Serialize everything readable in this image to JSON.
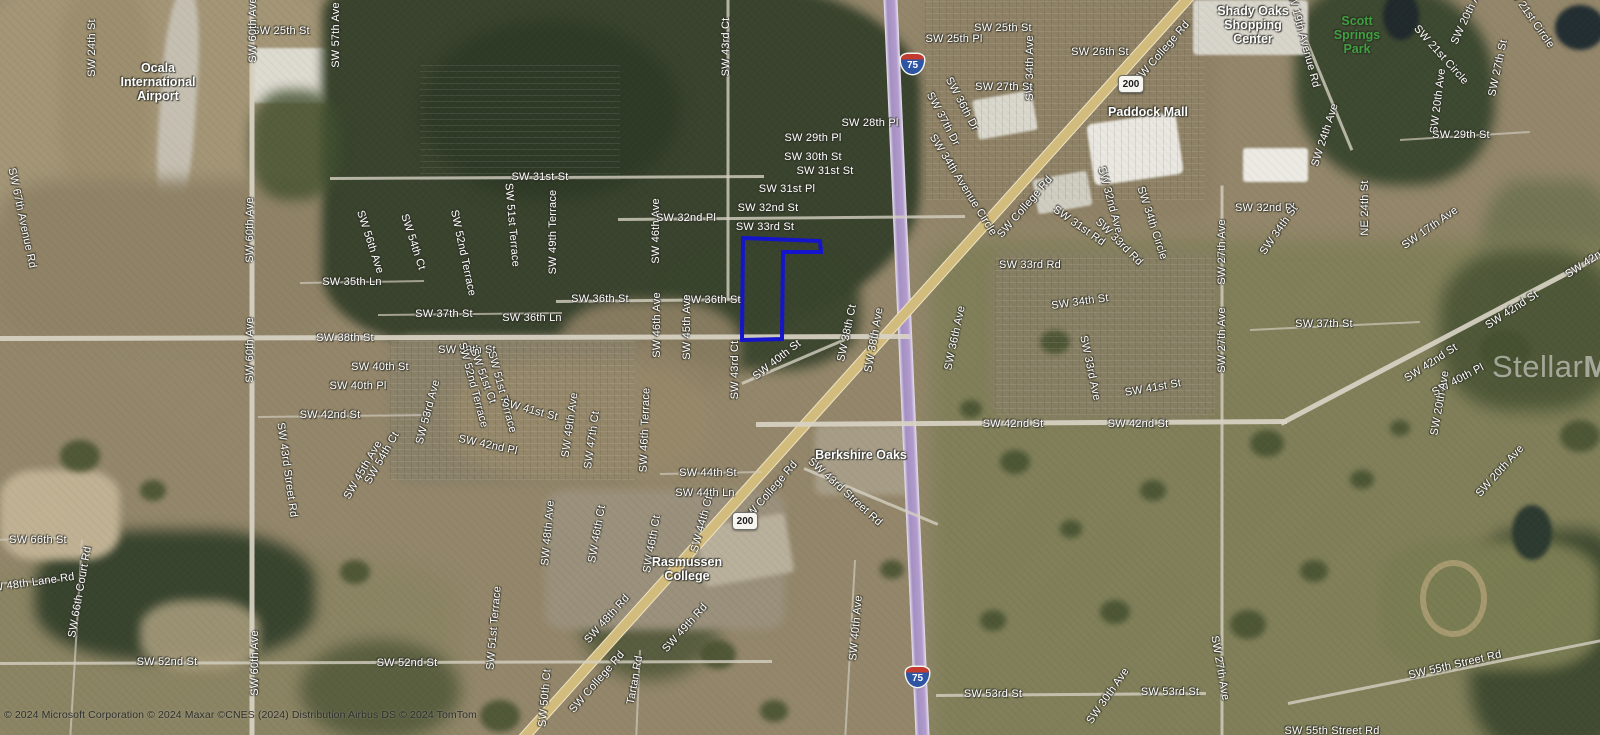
{
  "map": {
    "width": 1600,
    "height": 735,
    "attribution": "© 2024 Microsoft Corporation © 2024 Maxar ©CNES (2024) Distribution Airbus DS © 2024 TomTom",
    "watermark": {
      "brand_regular": "Stellar",
      "brand_bold": "MLS"
    },
    "colors": {
      "parcel_stroke": "#1414cd",
      "interstate_fill": "#2e55a3",
      "interstate_band": "#c23b2e",
      "state_shield_fill": "#f6f5f0",
      "park_label_green": "#3fa03f",
      "label_white": "#ffffff"
    },
    "parcel": {
      "stroke": "#1414cd",
      "stroke_width": 4,
      "points": [
        [
          743,
          238
        ],
        [
          820,
          241
        ],
        [
          821,
          252
        ],
        [
          783,
          252
        ],
        [
          782,
          339
        ],
        [
          742,
          340
        ]
      ]
    },
    "shields": [
      {
        "kind": "interstate",
        "t": "75",
        "x": 913,
        "y": 64
      },
      {
        "kind": "interstate",
        "t": "75",
        "x": 918,
        "y": 677
      },
      {
        "kind": "state",
        "t": "200",
        "x": 1130,
        "y": 85
      },
      {
        "kind": "state",
        "t": "200",
        "x": 744,
        "y": 522
      }
    ],
    "poi_labels": [
      {
        "t": "Ocala\nInternational\nAirport",
        "x": 158,
        "y": 82
      },
      {
        "t": "Shady Oaks\nShopping\nCenter",
        "x": 1253,
        "y": 25
      },
      {
        "t": "Scott\nSprings\nPark",
        "x": 1357,
        "y": 35,
        "c": "#3fa03f"
      },
      {
        "t": "Paddock Mall",
        "x": 1148,
        "y": 112
      },
      {
        "t": "Berkshire Oaks",
        "x": 861,
        "y": 455
      },
      {
        "t": "Rasmussen\nCollege",
        "x": 687,
        "y": 569
      }
    ],
    "roads": [
      {
        "n": "I-75",
        "k": "i",
        "x1": 890,
        "y1": -12,
        "x2": 923,
        "y2": 747
      },
      {
        "n": "SW College Rd",
        "k": "hw",
        "x1": 1196,
        "y1": -12,
        "x2": 514,
        "y2": 747
      },
      {
        "n": "SW 38th St",
        "k": "maj",
        "x1": -8,
        "y1": 338,
        "x2": 910,
        "y2": 336
      },
      {
        "n": "SW 42nd St",
        "k": "maj",
        "x1": 756,
        "y1": 424,
        "x2": 1287,
        "y2": 421
      },
      {
        "n": "SW 42nd St E",
        "k": "maj",
        "x1": 1281,
        "y1": 423,
        "x2": 1612,
        "y2": 249
      },
      {
        "n": "SW 60th Ave",
        "k": "maj",
        "x1": 252,
        "y1": -8,
        "x2": 252,
        "y2": 742
      },
      {
        "n": "SW 27th Ave",
        "k": "min",
        "x1": 1222,
        "y1": 185,
        "x2": 1222,
        "y2": 742
      },
      {
        "n": "SW 43rd Ct",
        "k": "min",
        "x1": 728,
        "y1": -8,
        "x2": 728,
        "y2": 300
      },
      {
        "n": "SW 31st St",
        "k": "min",
        "x1": 330,
        "y1": 178,
        "x2": 764,
        "y2": 176
      },
      {
        "n": "SW 32nd Pl",
        "k": "min",
        "x1": 618,
        "y1": 219,
        "x2": 965,
        "y2": 216
      },
      {
        "n": "SW 36th St",
        "k": "min",
        "x1": 556,
        "y1": 301,
        "x2": 744,
        "y2": 299
      },
      {
        "n": "SW 52nd St",
        "k": "min",
        "x1": -8,
        "y1": 663,
        "x2": 772,
        "y2": 661
      },
      {
        "n": "SW 53rd St",
        "k": "min",
        "x1": 936,
        "y1": 695,
        "x2": 1206,
        "y2": 693
      },
      {
        "n": "SW 55th Street Rd",
        "k": "min",
        "x1": 1288,
        "y1": 703,
        "x2": 1612,
        "y2": 638
      },
      {
        "n": "SW 43rd Street Rd",
        "k": "min",
        "x1": 804,
        "y1": 468,
        "x2": 938,
        "y2": 524
      },
      {
        "n": "SW 35th Ln",
        "k": "thin",
        "x1": 300,
        "y1": 283,
        "x2": 424,
        "y2": 281
      },
      {
        "n": "SW 37th St",
        "k": "thin",
        "x1": 378,
        "y1": 315,
        "x2": 562,
        "y2": 313
      },
      {
        "n": "SW 40th St",
        "k": "min",
        "x1": 742,
        "y1": 383,
        "x2": 845,
        "y2": 339
      },
      {
        "n": "SW 44th St",
        "k": "thin",
        "x1": 660,
        "y1": 474,
        "x2": 762,
        "y2": 472
      },
      {
        "n": "SW 19th Avenue Rd",
        "k": "min",
        "x1": 1290,
        "y1": 0,
        "x2": 1352,
        "y2": 150
      },
      {
        "n": "SW 66th Court Rd",
        "k": "thin",
        "x1": 82,
        "y1": 540,
        "x2": 70,
        "y2": 742
      },
      {
        "n": "SW 48th Lane Rd",
        "k": "thin",
        "x1": -8,
        "y1": 584,
        "x2": 60,
        "y2": 580
      },
      {
        "n": "SW 66th St",
        "k": "thin",
        "x1": -8,
        "y1": 540,
        "x2": 60,
        "y2": 538
      },
      {
        "n": "SW 42nd St W",
        "k": "thin",
        "x1": 258,
        "y1": 417,
        "x2": 430,
        "y2": 415
      },
      {
        "n": "SW 37th St E",
        "k": "thin",
        "x1": 1250,
        "y1": 330,
        "x2": 1420,
        "y2": 322
      },
      {
        "n": "SW 40th Ave",
        "k": "thin",
        "x1": 855,
        "y1": 560,
        "x2": 845,
        "y2": 742
      },
      {
        "n": "SW 29th St E",
        "k": "thin",
        "x1": 1400,
        "y1": 140,
        "x2": 1530,
        "y2": 132
      },
      {
        "n": "Tartan Rd",
        "k": "thin",
        "x1": 640,
        "y1": 650,
        "x2": 636,
        "y2": 742
      }
    ],
    "road_labels": [
      {
        "t": "SW 24th St",
        "x": 92,
        "y": 48,
        "r": -90
      },
      {
        "t": "SW 25th St",
        "x": 281,
        "y": 31,
        "r": 0
      },
      {
        "t": "SW 60th Ave",
        "x": 253,
        "y": 30,
        "r": -90
      },
      {
        "t": "SW 57th Ave",
        "x": 336,
        "y": 35,
        "r": -90
      },
      {
        "t": "SW 67th Avenue Rd",
        "x": 22,
        "y": 218,
        "r": 78
      },
      {
        "t": "SW 60th Ave",
        "x": 250,
        "y": 230,
        "r": -90
      },
      {
        "t": "SW 56th Ave",
        "x": 370,
        "y": 242,
        "r": 72
      },
      {
        "t": "SW 54th Ct",
        "x": 413,
        "y": 242,
        "r": 72
      },
      {
        "t": "SW 52nd Terrace",
        "x": 463,
        "y": 253,
        "r": 78
      },
      {
        "t": "SW 51st Terrace",
        "x": 512,
        "y": 225,
        "r": 85
      },
      {
        "t": "SW 49th Terrace",
        "x": 553,
        "y": 232,
        "r": -90
      },
      {
        "t": "SW 31st St",
        "x": 540,
        "y": 177,
        "r": 0
      },
      {
        "t": "SW 43rd Ct",
        "x": 726,
        "y": 47,
        "r": -90
      },
      {
        "t": "SW 46th Ave",
        "x": 656,
        "y": 231,
        "r": -90
      },
      {
        "t": "SW 32nd Pl",
        "x": 686,
        "y": 218,
        "r": 0
      },
      {
        "t": "SW 32nd St",
        "x": 768,
        "y": 208,
        "r": 0
      },
      {
        "t": "SW 31st Pl",
        "x": 787,
        "y": 189,
        "r": 0
      },
      {
        "t": "SW 31st St",
        "x": 825,
        "y": 171,
        "r": 0
      },
      {
        "t": "SW 30th St",
        "x": 813,
        "y": 157,
        "r": 0
      },
      {
        "t": "SW 29th Pl",
        "x": 813,
        "y": 138,
        "r": 0
      },
      {
        "t": "SW 28th Pl",
        "x": 870,
        "y": 123,
        "r": 0
      },
      {
        "t": "SW 33rd St",
        "x": 765,
        "y": 227,
        "r": 0
      },
      {
        "t": "SW 25th Pl",
        "x": 954,
        "y": 39,
        "r": 0
      },
      {
        "t": "SW 25th St",
        "x": 1003,
        "y": 28,
        "r": 0
      },
      {
        "t": "SW 26th St",
        "x": 1100,
        "y": 52,
        "r": 0
      },
      {
        "t": "SW 34th Ave",
        "x": 1030,
        "y": 68,
        "r": -90
      },
      {
        "t": "SW 27th St",
        "x": 1004,
        "y": 87,
        "r": 0
      },
      {
        "t": "SW 36th Dr",
        "x": 962,
        "y": 104,
        "r": 62
      },
      {
        "t": "SW 37th Dr",
        "x": 943,
        "y": 119,
        "r": 62
      },
      {
        "t": "SW College Rd",
        "x": 1162,
        "y": 52,
        "r": -49
      },
      {
        "t": "SW 34th Avenue Circle",
        "x": 963,
        "y": 185,
        "r": 58
      },
      {
        "t": "SW College Rd",
        "x": 1025,
        "y": 207,
        "r": -49
      },
      {
        "t": "SW 32nd Ave",
        "x": 1110,
        "y": 200,
        "r": 75
      },
      {
        "t": "SW 31st Rd",
        "x": 1079,
        "y": 226,
        "r": 35
      },
      {
        "t": "SW 34th Circle",
        "x": 1152,
        "y": 223,
        "r": 72
      },
      {
        "t": "SW 33rd Rd",
        "x": 1119,
        "y": 242,
        "r": 45
      },
      {
        "t": "SW 19th Avenue Rd",
        "x": 1303,
        "y": 38,
        "r": 75
      },
      {
        "t": "SW 20th Ave",
        "x": 1468,
        "y": 14,
        "r": -65
      },
      {
        "t": "SW 21st Circle",
        "x": 1530,
        "y": 16,
        "r": 55
      },
      {
        "t": "SW 21st Circle",
        "x": 1441,
        "y": 55,
        "r": 48
      },
      {
        "t": "SW 27th St",
        "x": 1498,
        "y": 68,
        "r": -78
      },
      {
        "t": "SW 20th Ave",
        "x": 1438,
        "y": 101,
        "r": -83
      },
      {
        "t": "SW 29th St",
        "x": 1461,
        "y": 135,
        "r": 0
      },
      {
        "t": "SW 24th Ave",
        "x": 1325,
        "y": 135,
        "r": -72
      },
      {
        "t": "NE 24th St",
        "x": 1365,
        "y": 208,
        "r": -90
      },
      {
        "t": "SW 32nd Pl",
        "x": 1265,
        "y": 208,
        "r": 0
      },
      {
        "t": "SW 34th St",
        "x": 1279,
        "y": 230,
        "r": -55
      },
      {
        "t": "SW 17th Ave",
        "x": 1430,
        "y": 228,
        "r": -35
      },
      {
        "t": "SW 35th Ln",
        "x": 352,
        "y": 282,
        "r": 0
      },
      {
        "t": "SW 38th St",
        "x": 345,
        "y": 338,
        "r": 0
      },
      {
        "t": "SW 60th Ave",
        "x": 250,
        "y": 350,
        "r": -90
      },
      {
        "t": "SW 40th St",
        "x": 380,
        "y": 367,
        "r": 0
      },
      {
        "t": "SW 40th Pl",
        "x": 358,
        "y": 386,
        "r": 0
      },
      {
        "t": "SW 42nd St",
        "x": 330,
        "y": 415,
        "r": 0
      },
      {
        "t": "SW 43rd Street Rd",
        "x": 287,
        "y": 470,
        "r": 82
      },
      {
        "t": "SW 45th Ave",
        "x": 363,
        "y": 470,
        "r": -60
      },
      {
        "t": "SW 54th Ct",
        "x": 382,
        "y": 458,
        "r": -60
      },
      {
        "t": "SW 36th St",
        "x": 600,
        "y": 299,
        "r": 0
      },
      {
        "t": "SW 36th St",
        "x": 712,
        "y": 300,
        "r": 0
      },
      {
        "t": "SW 37th St",
        "x": 444,
        "y": 314,
        "r": 0
      },
      {
        "t": "SW 36th Ln",
        "x": 532,
        "y": 318,
        "r": 0
      },
      {
        "t": "SW 39th St",
        "x": 467,
        "y": 350,
        "r": 0
      },
      {
        "t": "SW 46th Ave",
        "x": 657,
        "y": 325,
        "r": -90
      },
      {
        "t": "SW 45th Ave",
        "x": 687,
        "y": 327,
        "r": -90
      },
      {
        "t": "SW 43rd Ct",
        "x": 735,
        "y": 370,
        "r": -90
      },
      {
        "t": "SW 40th St",
        "x": 777,
        "y": 360,
        "r": -38
      },
      {
        "t": "SW 53rd Ave",
        "x": 428,
        "y": 412,
        "r": -75
      },
      {
        "t": "SW 52nd Terrace",
        "x": 473,
        "y": 385,
        "r": 75
      },
      {
        "t": "SW 51st Ct",
        "x": 483,
        "y": 376,
        "r": 70
      },
      {
        "t": "SW 51st Terrace",
        "x": 502,
        "y": 392,
        "r": 75
      },
      {
        "t": "SW 41st St",
        "x": 530,
        "y": 410,
        "r": 15
      },
      {
        "t": "SW 49th Ave",
        "x": 570,
        "y": 425,
        "r": -82
      },
      {
        "t": "SW 47th Ct",
        "x": 592,
        "y": 440,
        "r": -82
      },
      {
        "t": "SW 46th Terrace",
        "x": 645,
        "y": 430,
        "r": -88
      },
      {
        "t": "SW 42nd Pl",
        "x": 488,
        "y": 445,
        "r": 12
      },
      {
        "t": "SW 44th St",
        "x": 708,
        "y": 473,
        "r": 0
      },
      {
        "t": "SW 44th Ln",
        "x": 705,
        "y": 493,
        "r": 0
      },
      {
        "t": "SW College Rd",
        "x": 770,
        "y": 492,
        "r": -49
      },
      {
        "t": "SW 33rd Rd",
        "x": 1030,
        "y": 265,
        "r": 0
      },
      {
        "t": "SW 34th St",
        "x": 1080,
        "y": 302,
        "r": -8
      },
      {
        "t": "SW 38th Ct",
        "x": 847,
        "y": 333,
        "r": -78
      },
      {
        "t": "SW 38th Ave",
        "x": 874,
        "y": 340,
        "r": -80
      },
      {
        "t": "SW 36th Ave",
        "x": 955,
        "y": 338,
        "r": -78
      },
      {
        "t": "SW 33rd Ave",
        "x": 1090,
        "y": 368,
        "r": 78
      },
      {
        "t": "SW 41st St",
        "x": 1153,
        "y": 388,
        "r": -10
      },
      {
        "t": "SW 42nd St",
        "x": 1013,
        "y": 424,
        "r": 0
      },
      {
        "t": "SW 42nd St",
        "x": 1138,
        "y": 424,
        "r": 0
      },
      {
        "t": "SW 43rd Street Rd",
        "x": 845,
        "y": 492,
        "r": 42
      },
      {
        "t": "SW 27th Ave",
        "x": 1222,
        "y": 252,
        "r": -90
      },
      {
        "t": "SW 27th Ave",
        "x": 1222,
        "y": 340,
        "r": -90
      },
      {
        "t": "SW 37th St",
        "x": 1324,
        "y": 324,
        "r": 0
      },
      {
        "t": "SW 42nd St",
        "x": 1512,
        "y": 310,
        "r": -33
      },
      {
        "t": "SW 42nd St",
        "x": 1431,
        "y": 363,
        "r": -33
      },
      {
        "t": "SW 42nd St",
        "x": 1592,
        "y": 259,
        "r": -33
      },
      {
        "t": "SW 40th Pl",
        "x": 1458,
        "y": 380,
        "r": -28
      },
      {
        "t": "SW 20th Ave",
        "x": 1440,
        "y": 403,
        "r": -80
      },
      {
        "t": "SW 20th Ave",
        "x": 1500,
        "y": 471,
        "r": -48
      },
      {
        "t": "SW 66th St",
        "x": 38,
        "y": 540,
        "r": 0
      },
      {
        "t": "SW 48th Lane Rd",
        "x": 30,
        "y": 583,
        "r": -8
      },
      {
        "t": "SW 66th Court Rd",
        "x": 80,
        "y": 592,
        "r": -80
      },
      {
        "t": "SW 52nd St",
        "x": 167,
        "y": 662,
        "r": 0
      },
      {
        "t": "SW 60th Ave",
        "x": 255,
        "y": 663,
        "r": -90
      },
      {
        "t": "SW 44th Ct",
        "x": 702,
        "y": 524,
        "r": -75
      },
      {
        "t": "SW 48th Ave",
        "x": 548,
        "y": 533,
        "r": -85
      },
      {
        "t": "SW 46th Ct",
        "x": 597,
        "y": 534,
        "r": -80
      },
      {
        "t": "SW 46th Ct",
        "x": 652,
        "y": 544,
        "r": -80
      },
      {
        "t": "SW 51st Terrace",
        "x": 494,
        "y": 628,
        "r": -85
      },
      {
        "t": "SW 48th Rd",
        "x": 607,
        "y": 619,
        "r": -48
      },
      {
        "t": "SW 49th Rd",
        "x": 685,
        "y": 628,
        "r": -48
      },
      {
        "t": "SW 52nd St",
        "x": 407,
        "y": 663,
        "r": 0
      },
      {
        "t": "SW College Rd",
        "x": 597,
        "y": 682,
        "r": -49
      },
      {
        "t": "Tartan Rd",
        "x": 635,
        "y": 680,
        "r": -80
      },
      {
        "t": "SW 50th Ct",
        "x": 545,
        "y": 698,
        "r": -85
      },
      {
        "t": "SW 40th Ave",
        "x": 856,
        "y": 628,
        "r": -85
      },
      {
        "t": "SW 53rd St",
        "x": 993,
        "y": 694,
        "r": 0
      },
      {
        "t": "SW 30th Ave",
        "x": 1108,
        "y": 696,
        "r": -55
      },
      {
        "t": "SW 53rd St",
        "x": 1170,
        "y": 692,
        "r": 0
      },
      {
        "t": "SW 27th Ave",
        "x": 1220,
        "y": 668,
        "r": 80
      },
      {
        "t": "SW 55th Street Rd",
        "x": 1455,
        "y": 665,
        "r": -13
      },
      {
        "t": "SW 55th Street Rd",
        "x": 1332,
        "y": 731,
        "r": 0
      }
    ]
  }
}
